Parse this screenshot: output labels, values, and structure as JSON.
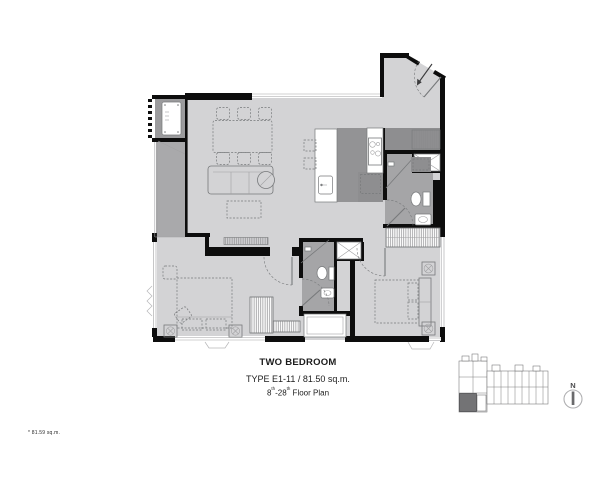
{
  "caption": {
    "title": "TWO BEDROOM",
    "type_line": "TYPE E1-11 / 81.50 sq.m.",
    "floor_line": {
      "from": "8",
      "from_sup": "th",
      "dash_to": "-28",
      "to_sup": "th",
      "suffix": " Floor Plan"
    }
  },
  "footnote": "* 81.59 sq.m.",
  "compass": {
    "label": "N"
  },
  "colors": {
    "wall": "#0d0d0d",
    "floor_light": "#d3d3d5",
    "floor_mid": "#a9a9ab",
    "floor_dark": "#939395",
    "cabinet": "#8e8e90",
    "closet": "#9b9b9d",
    "bath": "#a5a5a7",
    "line": "#77797b",
    "line_light": "#a2a2a4",
    "hatch": "#8a8a8c",
    "keyplan_highlight": "#737375",
    "text": "#1c1c1c"
  },
  "icons": {
    "compass": "north-compass-icon",
    "entry_arrow": "entry-direction-arrow"
  }
}
